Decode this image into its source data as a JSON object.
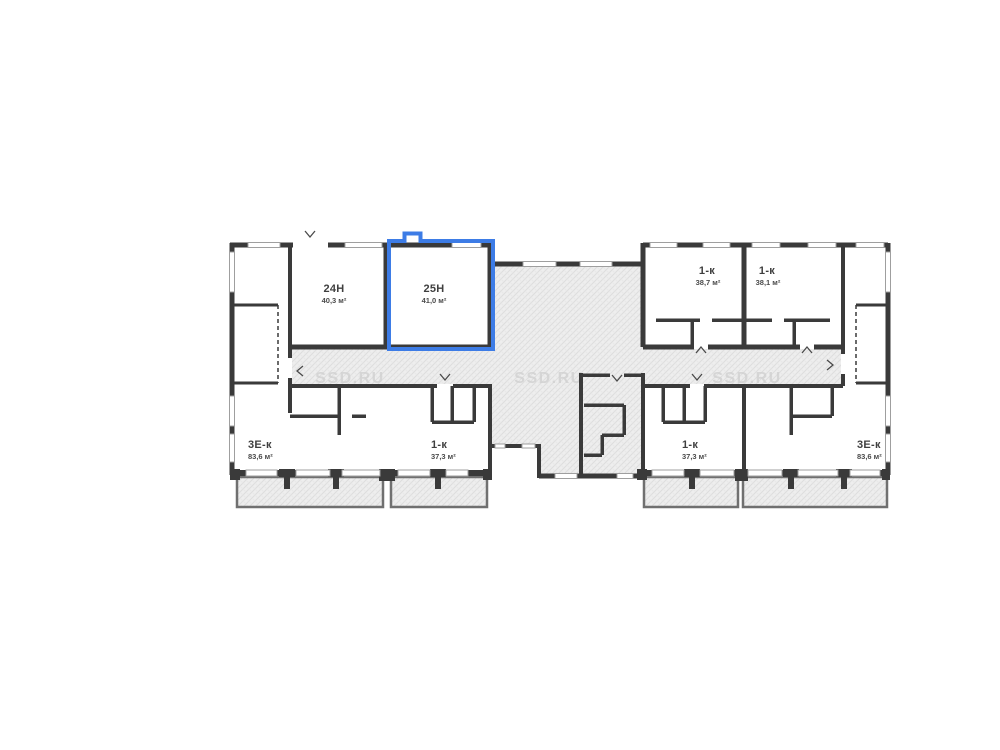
{
  "plan": {
    "type": "residential-floor-plan",
    "selected_unit": "25Н",
    "watermark": {
      "text": "SSD.RU",
      "color": "#d2d2d2"
    },
    "colors": {
      "highlight": "#3d7ce6",
      "wall": "#3a3a3a",
      "hatch_bg": "#eeeeee",
      "hatch_line": "#dddddd",
      "window_line": "#9f9f9f",
      "label": "#3f3f3f"
    },
    "units": [
      {
        "id": "24n",
        "name": "24Н",
        "area": "40,3 м²",
        "highlighted": false
      },
      {
        "id": "25n",
        "name": "25Н",
        "area": "41,0 м²",
        "highlighted": true
      },
      {
        "id": "1k-tl",
        "name": "1-к",
        "area": "38,7 м²",
        "highlighted": false
      },
      {
        "id": "1k-tr",
        "name": "1-к",
        "area": "38,1 м²",
        "highlighted": false
      },
      {
        "id": "3ek-bl",
        "name": "3Е-к",
        "area": "83,6 м²",
        "highlighted": false
      },
      {
        "id": "1k-bl",
        "name": "1-к",
        "area": "37,3 м²",
        "highlighted": false
      },
      {
        "id": "1k-br",
        "name": "1-к",
        "area": "37,3 м²",
        "highlighted": false
      },
      {
        "id": "3ek-br",
        "name": "3Е-к",
        "area": "83,6 м²",
        "highlighted": false
      }
    ]
  }
}
